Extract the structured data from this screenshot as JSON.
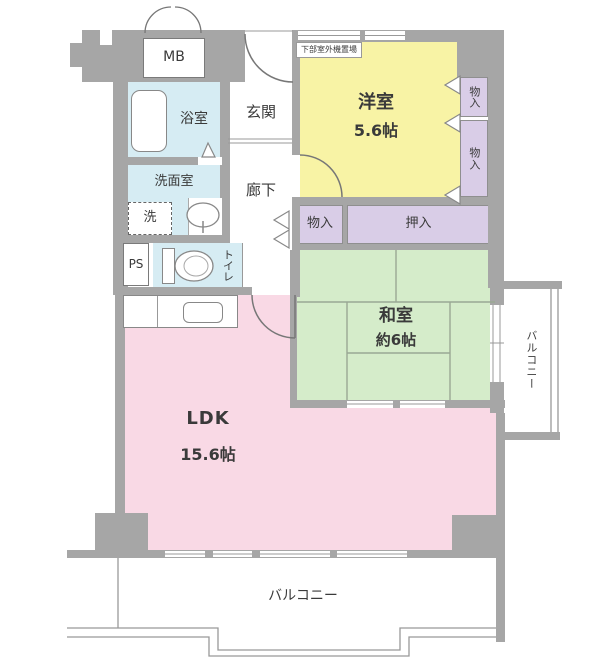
{
  "rooms": {
    "western_room": {
      "name": "洋室",
      "size": "5.6帖"
    },
    "japanese_room": {
      "name": "和室",
      "size": "約6帖"
    },
    "ldk": {
      "name": "LDK",
      "size": "15.6帖"
    },
    "entrance": {
      "name": "玄関"
    },
    "hallway": {
      "name": "廊下"
    },
    "bathroom": {
      "name": "浴室"
    },
    "washroom": {
      "name": "洗面室"
    },
    "toilet": {
      "name": "トイレ"
    },
    "washer": {
      "name": "洗"
    },
    "meter_box": {
      "name": "MB"
    },
    "pipe_space": {
      "name": "PS"
    },
    "storage_upper_right": {
      "name": "物入"
    },
    "storage_lower_right": {
      "name": "物入"
    },
    "storage_hall": {
      "name": "物入"
    },
    "futon_closet": {
      "name": "押入"
    },
    "balcony_right": {
      "name": "バルコニー"
    },
    "balcony_bottom": {
      "name": "バルコニー"
    },
    "outdoor_unit_space": {
      "name": "下部室外機置場"
    }
  },
  "colors": {
    "wall": "#a6a6a6",
    "western_room": "#f8f3a5",
    "japanese_room": "#d5ecca",
    "ldk": "#f9d9e5",
    "wet_area": "#d6ecf3",
    "storage": "#d9cde7"
  }
}
